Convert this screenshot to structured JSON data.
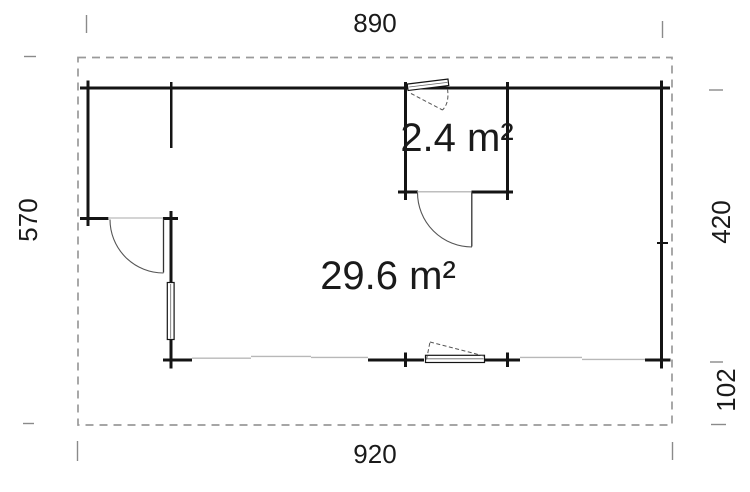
{
  "plan": {
    "title": "garden-house-floor-plan",
    "dimensions": {
      "top_width": "890",
      "bottom_width": "920",
      "left_height": "570",
      "right_upper_height": "420",
      "right_lower_height": "102"
    },
    "rooms": {
      "small_area": "2.4 m²",
      "large_area": "29.6 m²"
    },
    "colors": {
      "wall": "#141414",
      "roof_outline": "#9a9a9a",
      "open_side_line": "#b8b8b8",
      "door_arc": "#555555",
      "extension_tick": "#8a8a8a",
      "text": "#1a1a1a"
    }
  }
}
